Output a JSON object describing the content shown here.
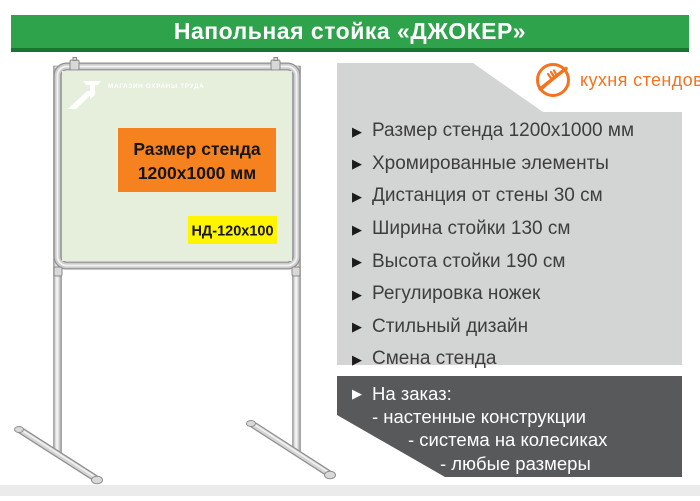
{
  "header": {
    "title": "Напольная стойка «ДЖОКЕР»"
  },
  "brand": {
    "name": "кухня стендов"
  },
  "icons": {
    "bullet": "▶"
  },
  "stand": {
    "board_logo_text": "МАГАЗИН ОХРАНЫ ТРУДА",
    "size_badge_line1": "Размер стенда",
    "size_badge_line2": "1200х1000  мм",
    "model_badge": "НД-120х100"
  },
  "features": {
    "items": [
      "Размер стенда 1200х1000 мм",
      "Хромированные элементы",
      "Дистанция от стены 30 см",
      "Ширина стойки 130 см",
      "Высота стойки 190 см",
      "Регулировка ножек",
      "Стильный дизайн",
      "Смена стенда"
    ]
  },
  "custom_order": {
    "title": "На заказ:",
    "items": [
      "- настенные конструкции",
      "- система на колесиках",
      "- любые размеры"
    ]
  },
  "colors": {
    "header_green": "#2fa24c",
    "header_green_dark": "#17752f",
    "brand_orange": "#f4731f",
    "size_badge_orange": "#f5821f",
    "model_badge_yellow": "#fff500",
    "board_green": "#e6eedc",
    "panel_gray": "#d3d4d4",
    "panel_dark": "#58595b"
  }
}
